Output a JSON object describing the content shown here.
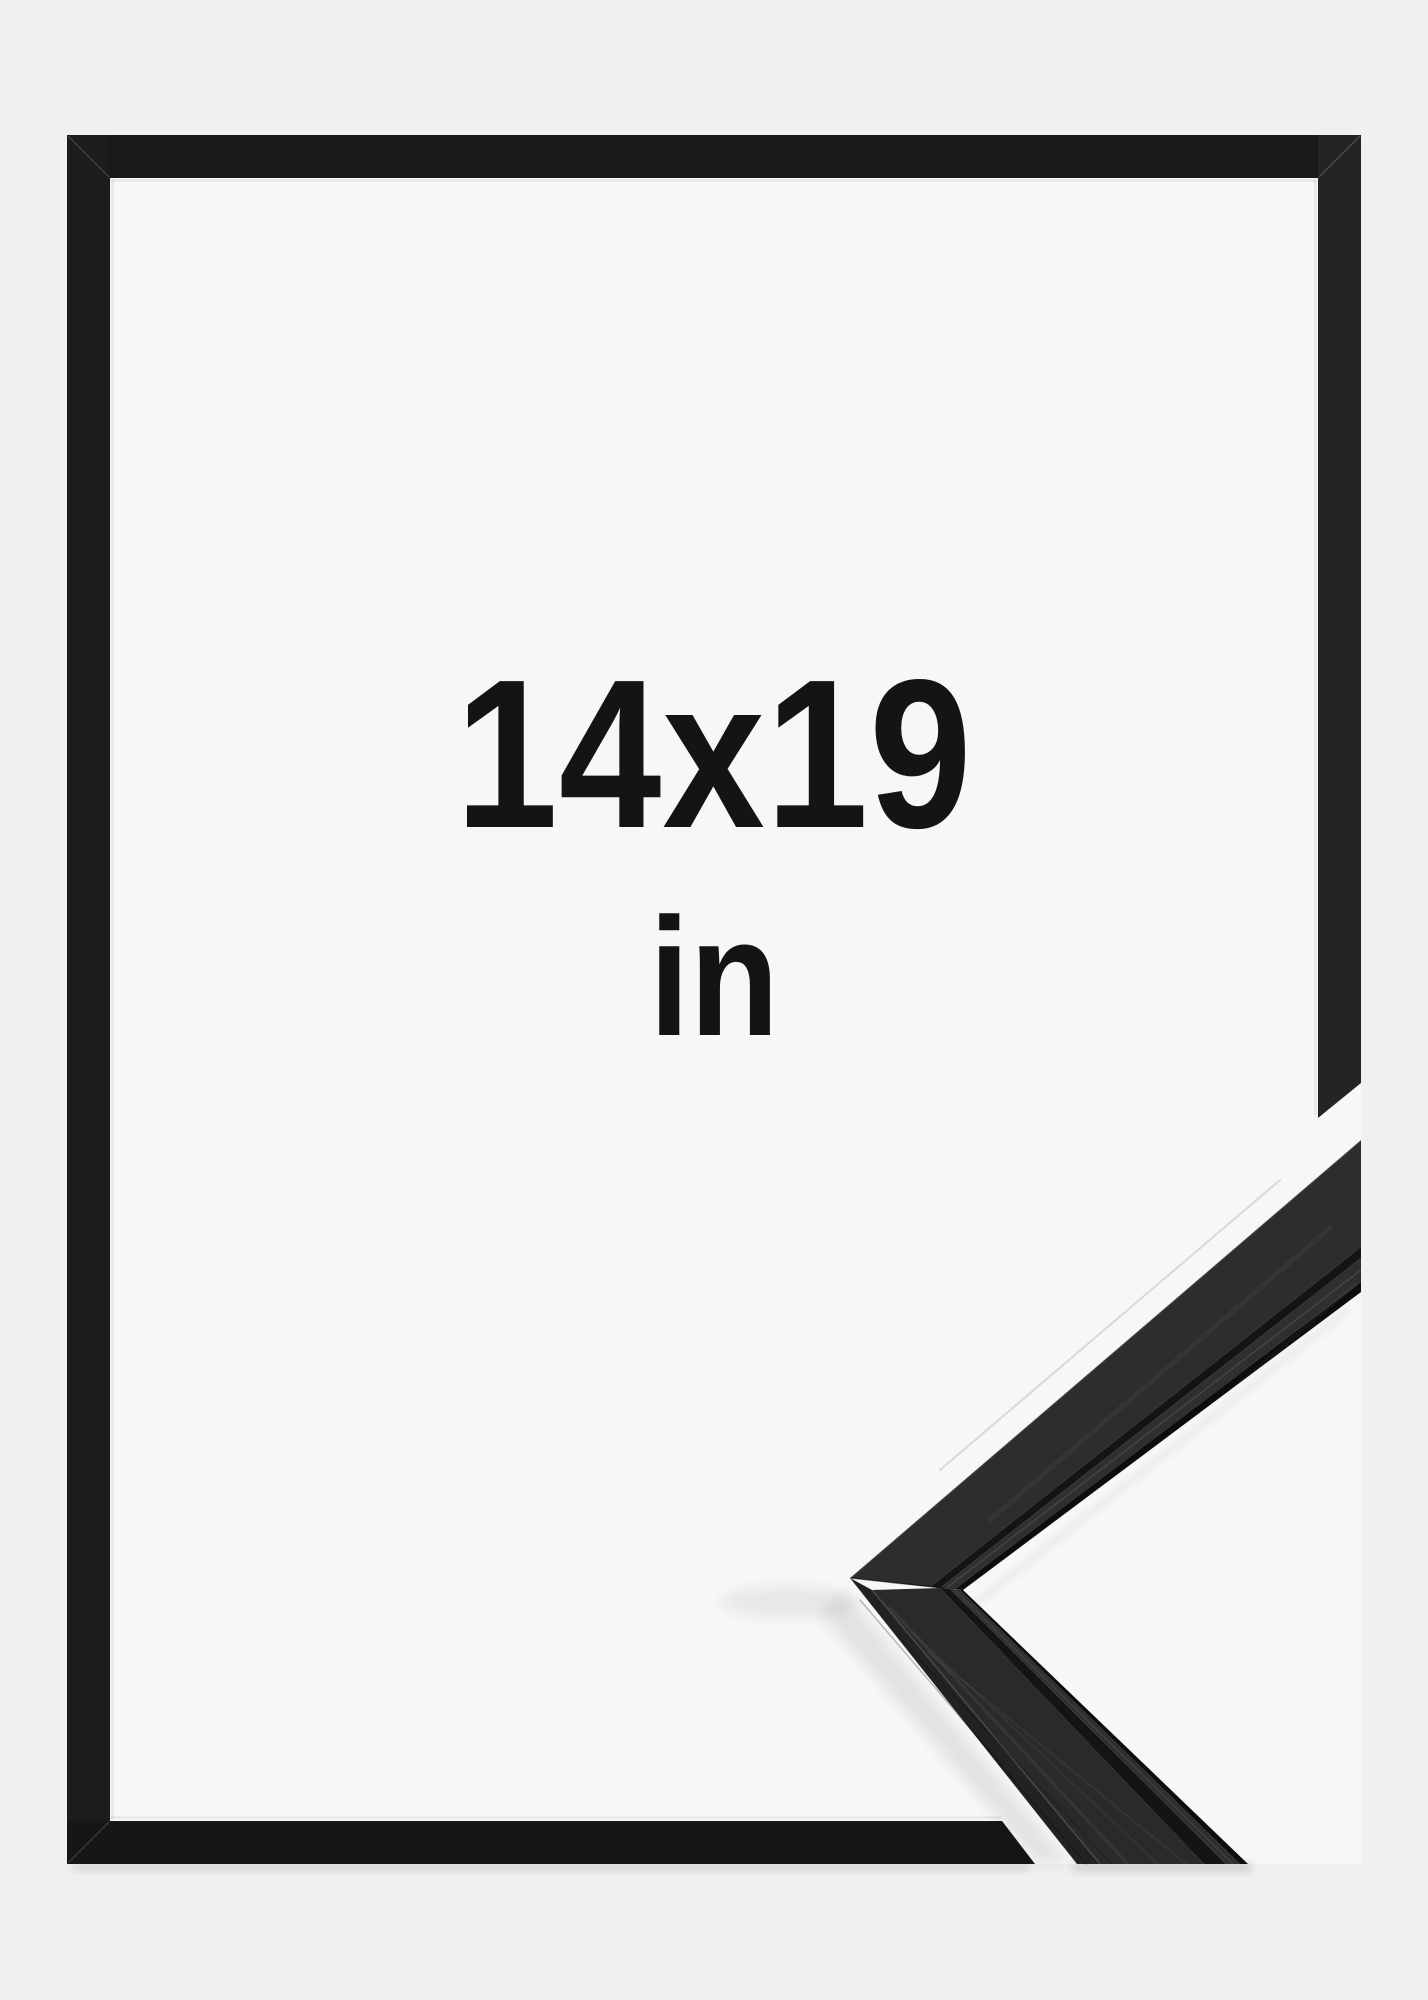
{
  "product_image": {
    "size_label": "14x19",
    "unit_label": "in",
    "colors": {
      "page_background": "#f0f0f1",
      "frame_interior": "#f7f7f8",
      "frame_black": "#1a191a",
      "frame_right_bar": "#242426",
      "frame_bottom_bar": "#161617",
      "moulding_face": "#2e2d2b",
      "moulding_side": "#232221",
      "moulding_groove": "#141414",
      "label_text": "#141414"
    }
  }
}
